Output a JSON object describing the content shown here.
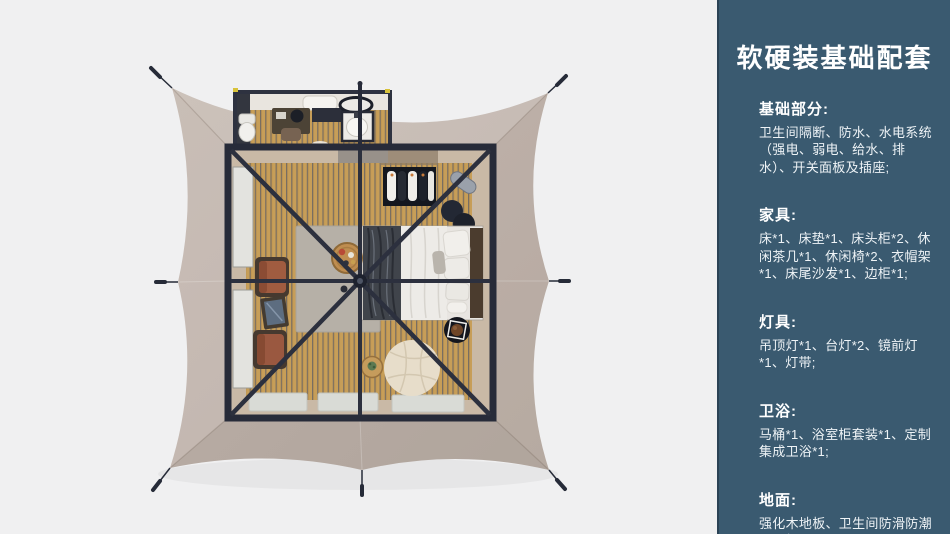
{
  "panel": {
    "title": "软硬装基础配套",
    "sections": [
      {
        "heading": "基础部分:",
        "body": "卫生间隔断、防水、水电系统（强电、弱电、给水、排水）、开关面板及插座;"
      },
      {
        "heading": "家具:",
        "body": "床*1、床垫*1、床头柜*2、休闲茶几*1、休闲椅*2、衣帽架*1、床尾沙发*1、边柜*1;"
      },
      {
        "heading": "灯具:",
        "body": "吊顶灯*1、台灯*2、镜前灯*1、灯带;"
      },
      {
        "heading": "卫浴:",
        "body": "马桶*1、浴室柜套装*1、定制集成卫浴*1;"
      },
      {
        "heading": "地面:",
        "body": "强化木地板、卫生间防滑防潮石塑板;"
      }
    ]
  },
  "illustration": {
    "alt": "顶视图：方形帐篷营地客房3D渲染（床、衣帽架、休闲椅、懒人沙发、卫生间）",
    "palette": {
      "background": "#f0f0f1",
      "canvas_tarp": "#c1b5ad",
      "tent_frame": "#272b39",
      "wood_floor": "#c79e58",
      "interior_wall": "#c9b9a6",
      "panel_background": "#3a5a70",
      "panel_edge": "#2b4255",
      "panel_text": "#ffffff",
      "leather_chair": "#a05c40",
      "bedding": "#eceae6",
      "blanket": "#3f434a"
    }
  }
}
